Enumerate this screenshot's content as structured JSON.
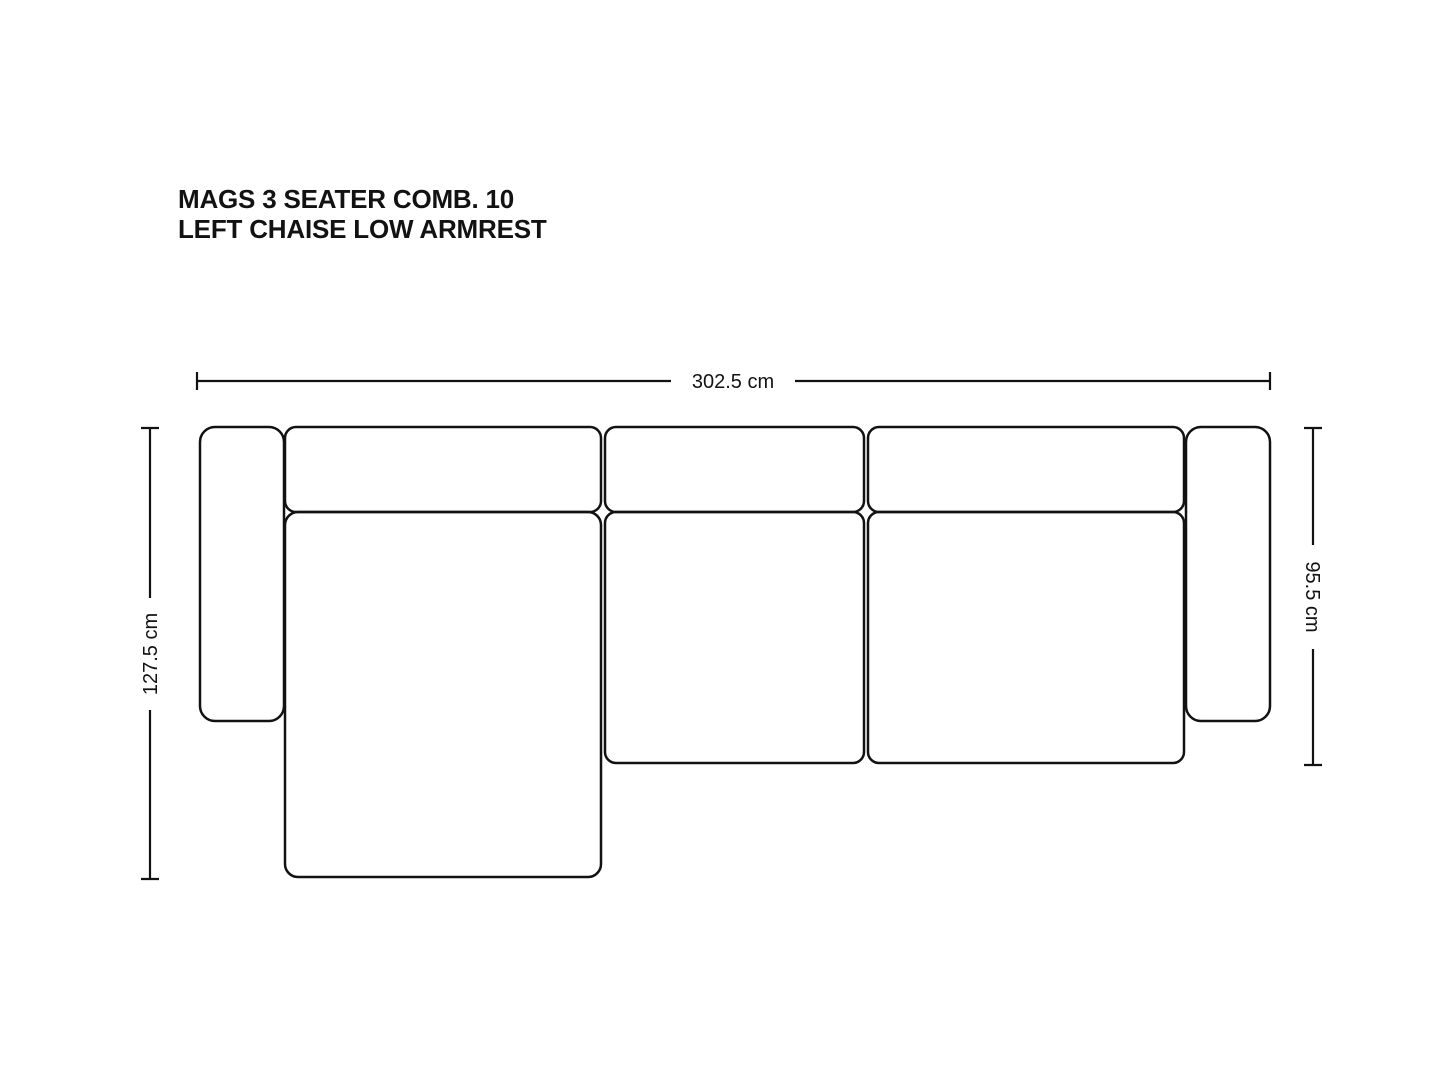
{
  "title": {
    "line1": "MAGS 3 SEATER COMB. 10",
    "line2": "LEFT CHAISE LOW ARMREST"
  },
  "dimensions": {
    "overall_width": "302.5 cm",
    "chaise_depth": "127.5 cm",
    "sofa_depth": "95.5 cm"
  },
  "colors": {
    "ink": "#121212",
    "background": "#ffffff"
  }
}
